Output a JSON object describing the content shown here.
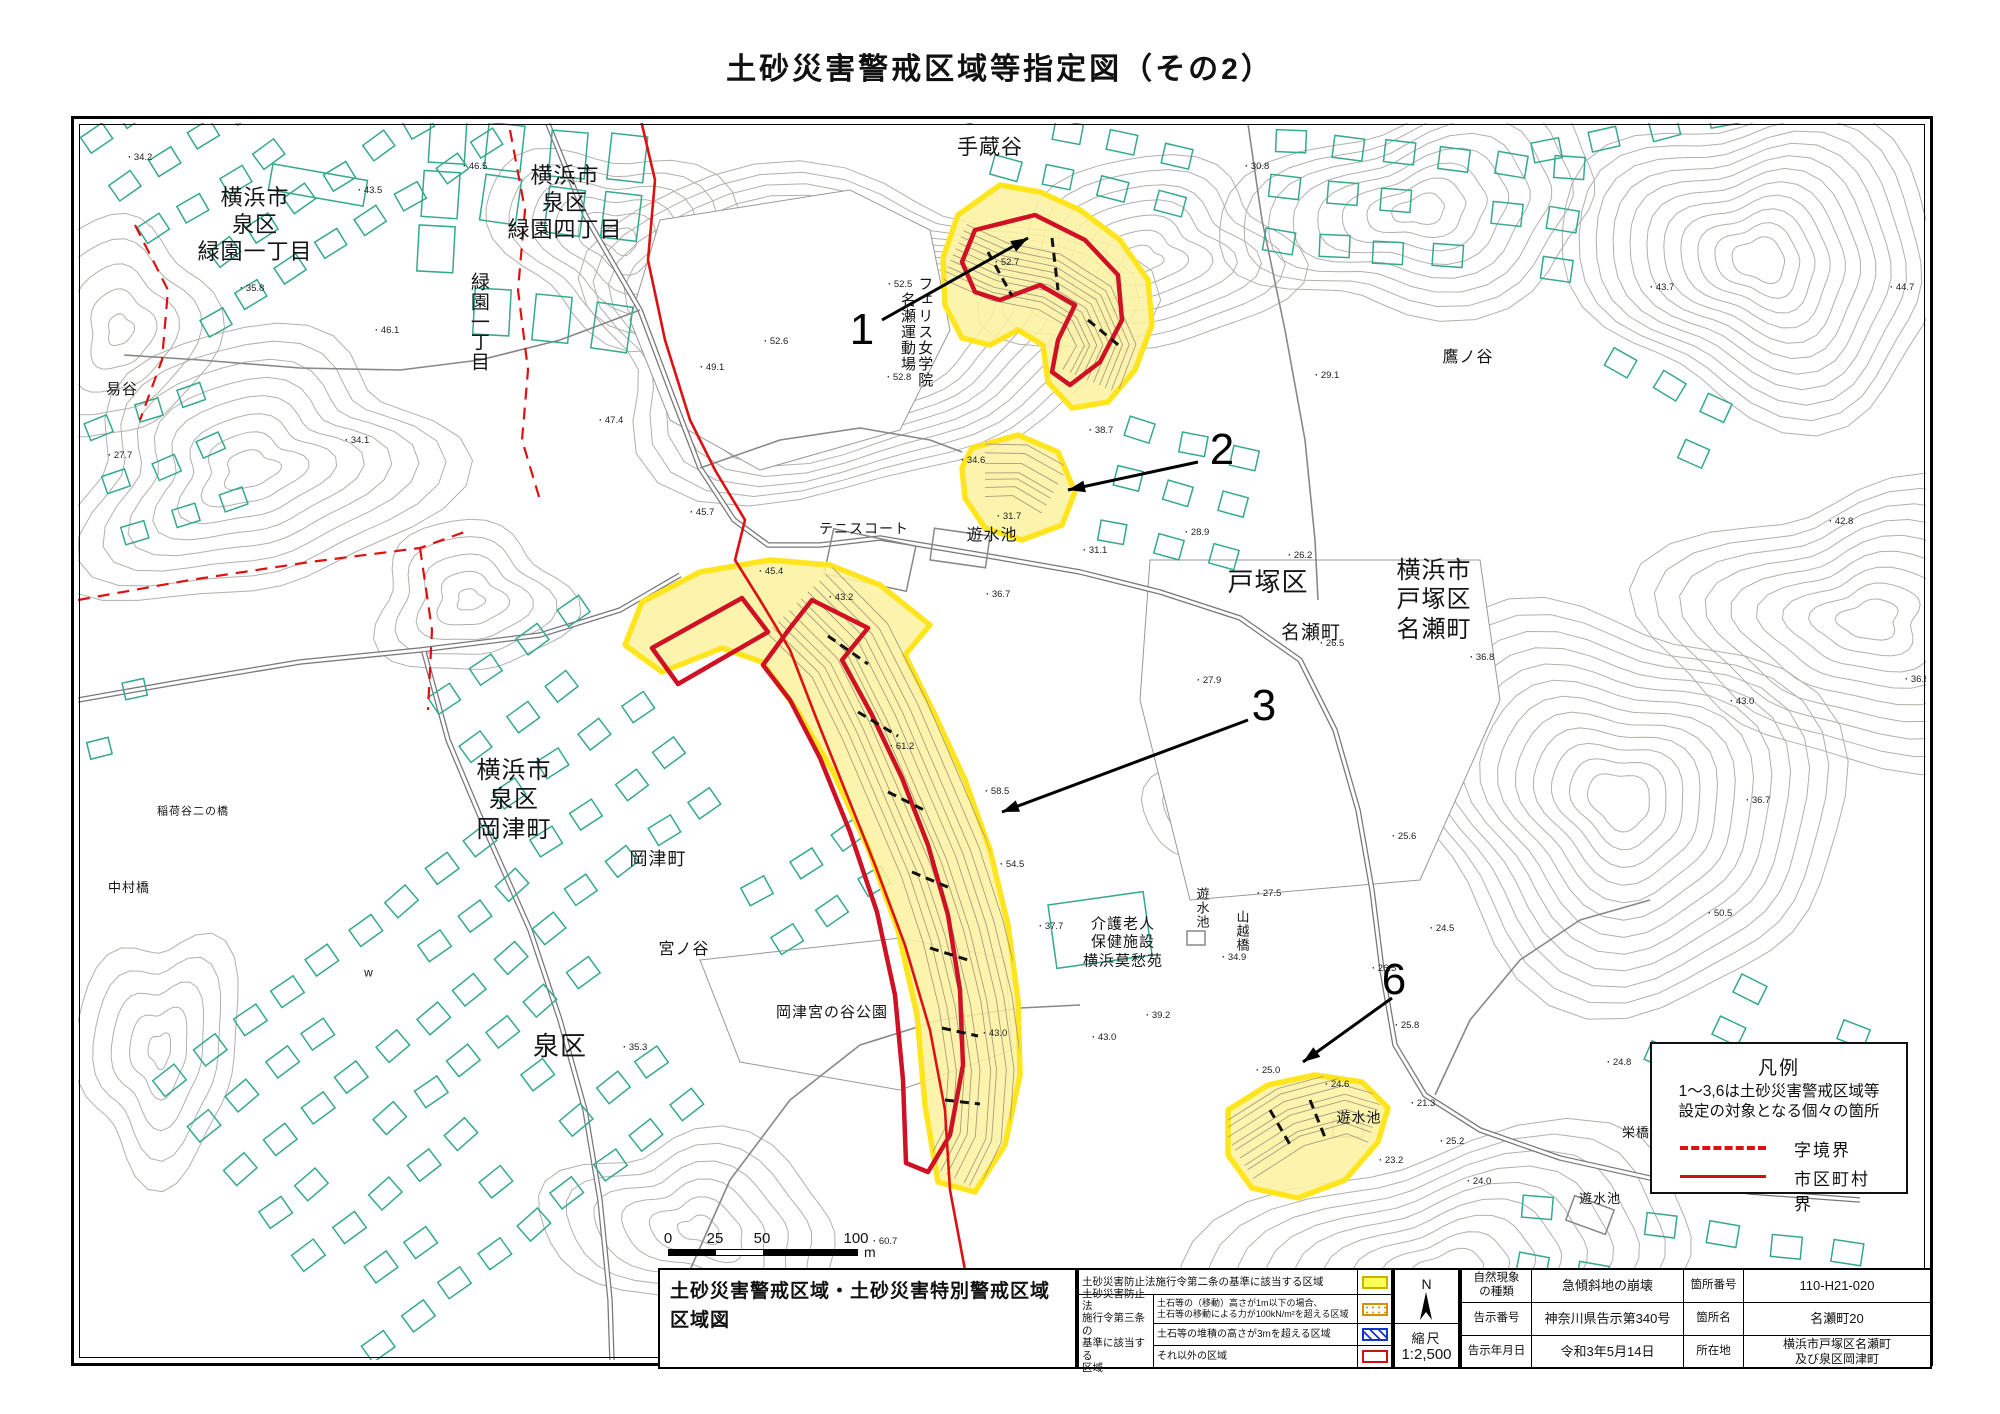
{
  "page_title": "土砂災害警戒区域等指定図（その2）",
  "colors": {
    "zone_yellow": "#fcf3a2",
    "zone_yellow_edge": "#ffe51e",
    "special_red": "#cf1126",
    "boundary_red": "#dd1111",
    "building_teal": "#35a98c",
    "contour_gray": "#b3b0aa",
    "hatch_orange": "#d4920a",
    "hatch_blue": "#1535c8"
  },
  "map": {
    "labels": [
      {
        "text": "横浜市\n泉区\n緑園一丁目",
        "x": 255,
        "y": 225,
        "size": 22,
        "vertical": false
      },
      {
        "text": "横浜市\n泉区\n緑園四丁目",
        "x": 565,
        "y": 203,
        "size": 22,
        "vertical": false
      },
      {
        "text": "緑園一丁目",
        "x": 478,
        "y": 322,
        "size": 19,
        "vertical": true
      },
      {
        "text": "易谷",
        "x": 122,
        "y": 390,
        "size": 15,
        "vertical": false
      },
      {
        "text": "手蔵谷",
        "x": 990,
        "y": 148,
        "size": 21,
        "vertical": false
      },
      {
        "text": "フェリス女学院\n名瀬運動場",
        "x": 916,
        "y": 332,
        "size": 15,
        "vertical": true
      },
      {
        "text": "テニスコート",
        "x": 864,
        "y": 529,
        "size": 14,
        "vertical": false
      },
      {
        "text": "遊水池",
        "x": 992,
        "y": 536,
        "size": 16,
        "vertical": false
      },
      {
        "text": "戸塚区",
        "x": 1268,
        "y": 583,
        "size": 26,
        "vertical": false
      },
      {
        "text": "名瀬町",
        "x": 1311,
        "y": 633,
        "size": 19,
        "vertical": false
      },
      {
        "text": "横浜市\n戸塚区\n名瀬町",
        "x": 1434,
        "y": 600,
        "size": 24,
        "vertical": false
      },
      {
        "text": "鷹ノ谷",
        "x": 1468,
        "y": 358,
        "size": 16,
        "vertical": false
      },
      {
        "text": "横浜市\n泉区\n岡津町",
        "x": 514,
        "y": 800,
        "size": 24,
        "vertical": false
      },
      {
        "text": "岡津町",
        "x": 658,
        "y": 860,
        "size": 18,
        "vertical": false
      },
      {
        "text": "稲荷谷二の橋",
        "x": 193,
        "y": 812,
        "size": 11,
        "vertical": false
      },
      {
        "text": "中村橋",
        "x": 129,
        "y": 888,
        "size": 13,
        "vertical": false
      },
      {
        "text": "宮ノ谷",
        "x": 684,
        "y": 950,
        "size": 16,
        "vertical": false
      },
      {
        "text": "泉区",
        "x": 560,
        "y": 1047,
        "size": 26,
        "vertical": false
      },
      {
        "text": "岡津宮の谷公園",
        "x": 832,
        "y": 1013,
        "size": 15,
        "vertical": false
      },
      {
        "text": "介護老人\n保健施設\n横浜莫愁苑",
        "x": 1123,
        "y": 943,
        "size": 15,
        "vertical": false
      },
      {
        "text": "遊水池",
        "x": 1201,
        "y": 908,
        "size": 13,
        "vertical": true
      },
      {
        "text": "山越橋",
        "x": 1241,
        "y": 931,
        "size": 13,
        "vertical": true
      },
      {
        "text": "栄橋",
        "x": 1636,
        "y": 1133,
        "size": 13,
        "vertical": false
      },
      {
        "text": "遊水池",
        "x": 1359,
        "y": 1118,
        "size": 14,
        "vertical": false
      },
      {
        "text": "遊水池",
        "x": 1600,
        "y": 1199,
        "size": 13,
        "vertical": false
      },
      {
        "text": "w",
        "x": 369,
        "y": 973,
        "size": 12,
        "vertical": false
      }
    ],
    "spot_heights": [
      {
        "v": "34.2",
        "x": 128,
        "y": 157
      },
      {
        "v": "43.5",
        "x": 358,
        "y": 190
      },
      {
        "v": "46.5",
        "x": 463,
        "y": 166
      },
      {
        "v": "35.8",
        "x": 240,
        "y": 288
      },
      {
        "v": "46.1",
        "x": 375,
        "y": 330
      },
      {
        "v": "27.7",
        "x": 108,
        "y": 455
      },
      {
        "v": "34.1",
        "x": 345,
        "y": 440
      },
      {
        "v": "47.4",
        "x": 599,
        "y": 420
      },
      {
        "v": "45.7",
        "x": 690,
        "y": 512
      },
      {
        "v": "52.5",
        "x": 888,
        "y": 284
      },
      {
        "v": "52.6",
        "x": 764,
        "y": 341
      },
      {
        "v": "52.8",
        "x": 887,
        "y": 377
      },
      {
        "v": "49.1",
        "x": 700,
        "y": 367
      },
      {
        "v": "52.7",
        "x": 995,
        "y": 262
      },
      {
        "v": "30.8",
        "x": 1245,
        "y": 166
      },
      {
        "v": "43.7",
        "x": 1650,
        "y": 287
      },
      {
        "v": "44.7",
        "x": 1890,
        "y": 287
      },
      {
        "v": "29.1",
        "x": 1315,
        "y": 375
      },
      {
        "v": "42.8",
        "x": 1829,
        "y": 521
      },
      {
        "v": "26.2",
        "x": 1288,
        "y": 555
      },
      {
        "v": "26.5",
        "x": 1320,
        "y": 643
      },
      {
        "v": "27.9",
        "x": 1197,
        "y": 680
      },
      {
        "v": "36.8",
        "x": 1470,
        "y": 657
      },
      {
        "v": "36.8",
        "x": 1905,
        "y": 679
      },
      {
        "v": "43.0",
        "x": 1730,
        "y": 701
      },
      {
        "v": "36.7",
        "x": 1746,
        "y": 800
      },
      {
        "v": "50.5",
        "x": 1708,
        "y": 913
      },
      {
        "v": "38.7",
        "x": 1089,
        "y": 430
      },
      {
        "v": "34.6",
        "x": 961,
        "y": 460
      },
      {
        "v": "31.7",
        "x": 997,
        "y": 516
      },
      {
        "v": "28.9",
        "x": 1185,
        "y": 532
      },
      {
        "v": "31.1",
        "x": 1083,
        "y": 550
      },
      {
        "v": "36.7",
        "x": 986,
        "y": 594
      },
      {
        "v": "43.2",
        "x": 829,
        "y": 597
      },
      {
        "v": "45.4",
        "x": 759,
        "y": 571
      },
      {
        "v": "61.2",
        "x": 890,
        "y": 746
      },
      {
        "v": "58.5",
        "x": 985,
        "y": 791
      },
      {
        "v": "54.5",
        "x": 1000,
        "y": 864
      },
      {
        "v": "37.7",
        "x": 1039,
        "y": 926
      },
      {
        "v": "27.5",
        "x": 1257,
        "y": 893
      },
      {
        "v": "34.9",
        "x": 1222,
        "y": 957
      },
      {
        "v": "39.2",
        "x": 1146,
        "y": 1015
      },
      {
        "v": "43.0",
        "x": 1092,
        "y": 1037
      },
      {
        "v": "26.5",
        "x": 1372,
        "y": 968
      },
      {
        "v": "25.8",
        "x": 1395,
        "y": 1025
      },
      {
        "v": "25.0",
        "x": 1256,
        "y": 1070
      },
      {
        "v": "24.6",
        "x": 1325,
        "y": 1084
      },
      {
        "v": "21.3",
        "x": 1411,
        "y": 1103
      },
      {
        "v": "25.2",
        "x": 1440,
        "y": 1141
      },
      {
        "v": "23.2",
        "x": 1379,
        "y": 1160
      },
      {
        "v": "24.0",
        "x": 1467,
        "y": 1181
      },
      {
        "v": "24.8",
        "x": 1607,
        "y": 1062
      },
      {
        "v": "25.6",
        "x": 1392,
        "y": 836
      },
      {
        "v": "24.5",
        "x": 1430,
        "y": 928
      },
      {
        "v": "35.3",
        "x": 623,
        "y": 1047
      },
      {
        "v": "43.0",
        "x": 983,
        "y": 1033
      },
      {
        "v": "60.7",
        "x": 873,
        "y": 1241
      },
      {
        "v": "29.2",
        "x": 1862,
        "y": 1096
      }
    ],
    "zones": [
      {
        "label": "1",
        "x": 862,
        "y": 330,
        "arrow": [
          882,
          320,
          1028,
          238
        ]
      },
      {
        "label": "2",
        "x": 1222,
        "y": 450,
        "arrow": [
          1198,
          462,
          1068,
          490
        ]
      },
      {
        "label": "3",
        "x": 1264,
        "y": 706,
        "arrow": [
          1248,
          720,
          1002,
          812
        ]
      },
      {
        "label": "6",
        "x": 1394,
        "y": 980,
        "arrow": [
          1392,
          998,
          1303,
          1062
        ]
      }
    ],
    "legend_box": {
      "title": "凡例",
      "note": "1～3,6は土砂災害警戒区域等\n設定の対象となる個々の箇所",
      "dashed_label": "字境界",
      "solid_label": "市区町村界"
    },
    "scale_bar": {
      "ticks": [
        "0",
        "25",
        "50",
        "100"
      ],
      "unit": "m"
    }
  },
  "title_block": {
    "sheet_title": "土砂災害警戒区域・土砂災害特別警戒区域\n区域図",
    "law": {
      "row1": "土砂災害防止法施行令第二条の基準に該当する区域",
      "group": "土砂災害防止法\n施行令第三条の\n基準に該当する\n区域",
      "row2": "土石等の（移動）高さが1m以下の場合、\n土石等の移動による力が100kN/m²を超える区域",
      "row3": "土石等の堆積の高さが3mを超える区域",
      "row4": "それ以外の区域"
    },
    "compass_n": "N",
    "scale_label": "縮尺",
    "scale_value": "1:2,500",
    "info": {
      "r1_label": "自然現象\nの種類",
      "r1_value": "急傾斜地の崩壊",
      "r1_label2": "箇所番号",
      "r1_value2": "110-H21-020",
      "r2_label": "告示番号",
      "r2_value": "神奈川県告示第340号",
      "r2_label2": "箇所名",
      "r2_value2": "名瀬町20",
      "r3_label": "告示年月日",
      "r3_value": "令和3年5月14日",
      "r3_label2": "所在地",
      "r3_value2": "横浜市戸塚区名瀬町\n及び泉区岡津町"
    }
  }
}
